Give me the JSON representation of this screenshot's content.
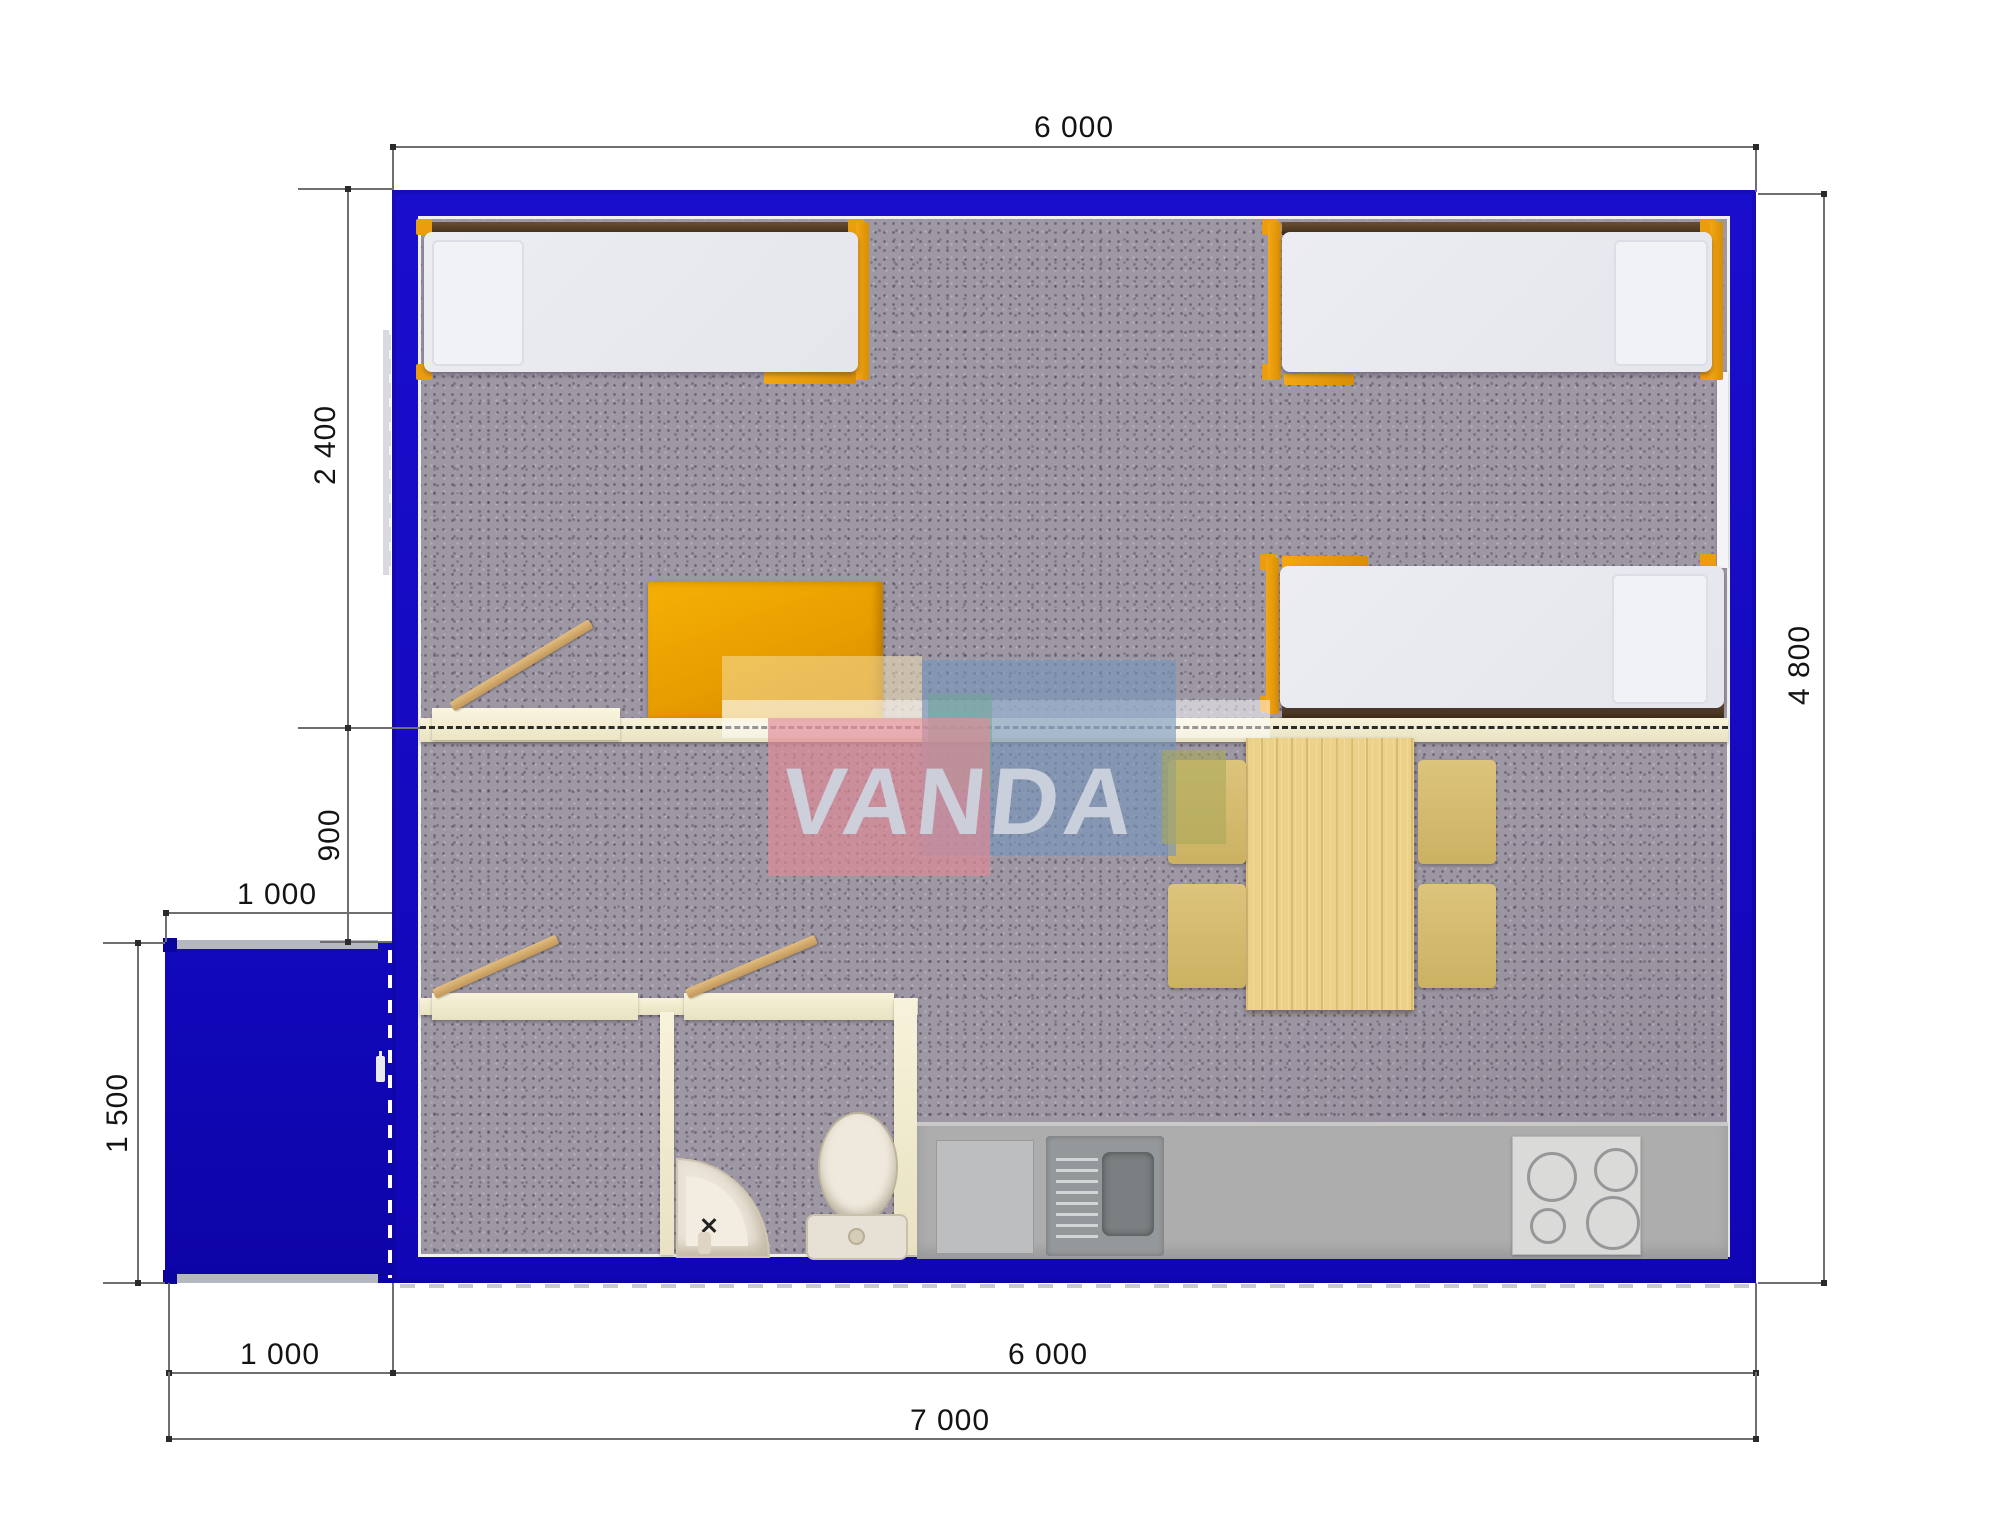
{
  "watermark": {
    "text": "VANDA"
  },
  "dimensions": {
    "top_width": "6 000",
    "right_height": "4 800",
    "left_bedroom_depth": "2 400",
    "left_passage": "900",
    "porch_width": "1 000",
    "porch_depth": "1 500",
    "bottom_porch_width": "1 000",
    "bottom_body_width": "6 000",
    "bottom_total_width": "7 000"
  },
  "colors": {
    "wall_blue": "#1409c4",
    "porch_blue": "#0e05b0",
    "floor_carpet": "#9e97a4",
    "partition_cream": "#f0ead0",
    "bed_mattress": "#e9eaef",
    "bed_frame_orange": "#ef9f0e",
    "wardrobe_orange": "#f0a800",
    "headboard_brown": "#553e26",
    "table_wood": "#ecd28c",
    "chair_wood": "#d6bd72",
    "counter_gray": "#ababab",
    "stove_panel": "#dadad8",
    "sink_unit": "#95989a",
    "sanitary_bone": "#e8e1d5",
    "dimension_line": "#6f6f6f",
    "dimension_text": "#141414",
    "watermark_pink": "rgba(222,138,150,0.68)",
    "watermark_blue": "rgba(118,150,188,0.62)",
    "watermark_letters": "#ccd3de"
  }
}
